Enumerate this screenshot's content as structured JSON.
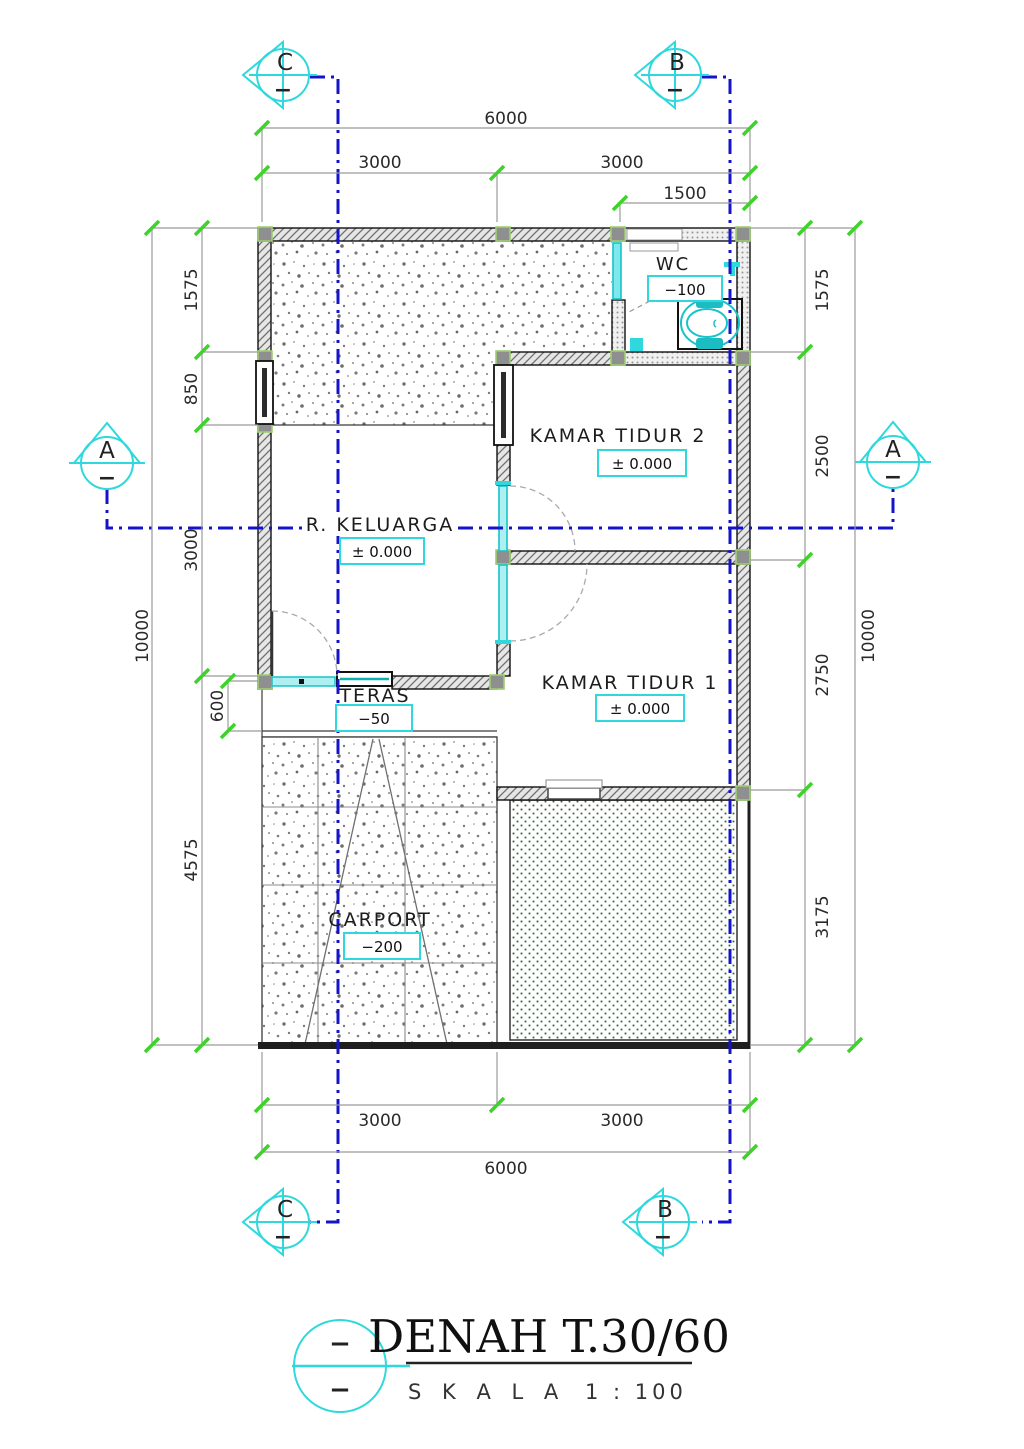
{
  "colors": {
    "cyan_accent": "#2fd8dc",
    "section_blue": "#1414cc",
    "tick_green": "#3ed32a",
    "wall_line": "#111111",
    "dim_gray": "#999999",
    "garden_green": "#3f5b40"
  },
  "markers": {
    "top_left": "C",
    "top_right": "B",
    "side_left": "A",
    "side_right": "A",
    "bottom_left": "C",
    "bottom_right": "B",
    "dash": "−"
  },
  "rooms": {
    "wc": {
      "name": "WC",
      "level": "−100"
    },
    "kt2": {
      "name": "KAMAR TIDUR 2",
      "level": "± 0.000"
    },
    "keluarga": {
      "name": "R. KELUARGA",
      "level": "± 0.000"
    },
    "kt1": {
      "name": "KAMAR TIDUR 1",
      "level": "± 0.000"
    },
    "teras": {
      "name": "TERAS",
      "level": "−50"
    },
    "carport": {
      "name": "CARPORT",
      "level": "−200"
    }
  },
  "dims": {
    "top_total": "6000",
    "top_left": "3000",
    "top_right": "3000",
    "top_wc": "1500",
    "left_1": "1575",
    "left_2": "850",
    "left_3": "3000",
    "left_4": "600",
    "left_5": "4575",
    "left_total": "10000",
    "right_1": "1575",
    "right_2": "2500",
    "right_3": "2750",
    "right_4": "3175",
    "right_total": "10000",
    "bottom_left": "3000",
    "bottom_right": "3000",
    "bottom_total": "6000"
  },
  "title_block": {
    "title": "DENAH T.30/60",
    "scale_label": "S K A L A",
    "scale_value": "1 : 100",
    "dash_top": "−",
    "dash_bottom": "−"
  }
}
